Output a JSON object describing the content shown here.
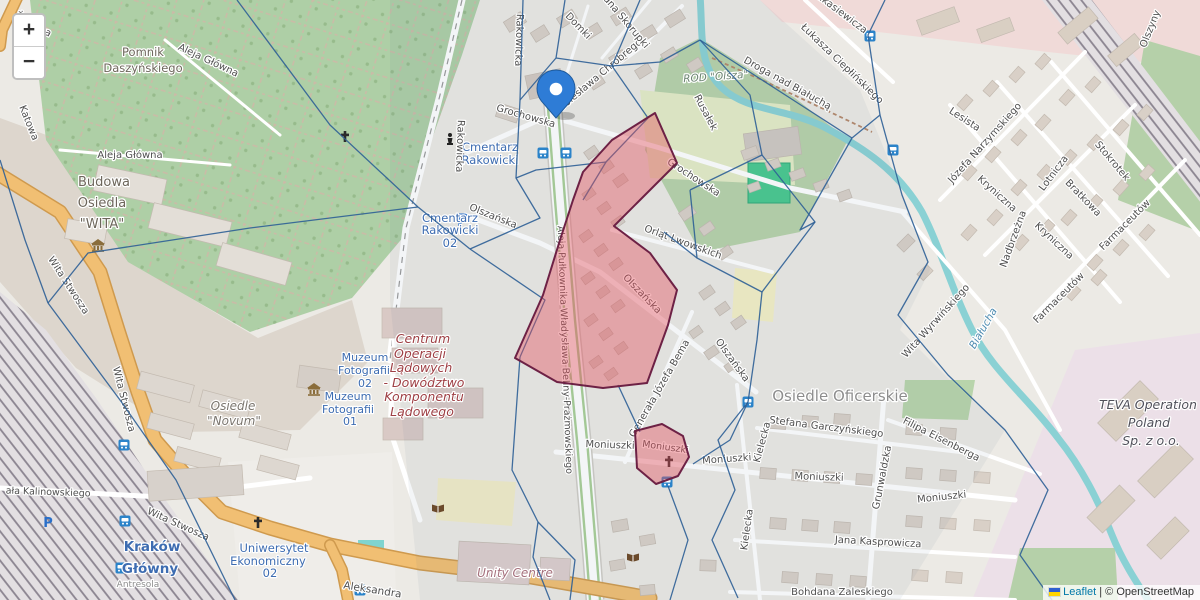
{
  "controls": {
    "zoom_in": "+",
    "zoom_out": "−"
  },
  "attribution": {
    "leaflet": "Leaflet",
    "separator": "|",
    "osm": "© OpenStreetMap"
  },
  "colors": {
    "voronoi_line": "#2e5f96",
    "highlight_fill": "#e4525e",
    "highlight_border": "#6d2145",
    "marker_blue": "#2e7cd6",
    "road_orange": "#f1bf73",
    "river_teal": "#8ad1d4",
    "cemetery_green": "#aecfa6",
    "poi_blue": "#3d6cb1"
  },
  "map": {
    "marker": {
      "x": 556,
      "y": 118
    },
    "overlay": {
      "voronoi": [
        [
          [
            237,
            0
          ],
          [
            330,
            125
          ],
          [
            418,
            207
          ]
        ],
        [
          [
            418,
            207
          ],
          [
            470,
            249
          ]
        ],
        [
          [
            418,
            207
          ],
          [
            250,
            228
          ],
          [
            88,
            253
          ],
          [
            48,
            303
          ]
        ],
        [
          [
            0,
            160
          ],
          [
            25,
            240
          ],
          [
            48,
            303
          ]
        ],
        [
          [
            48,
            303
          ],
          [
            120,
            400
          ],
          [
            176,
            480
          ],
          [
            235,
            600
          ]
        ],
        [
          [
            470,
            249
          ],
          [
            540,
            218
          ],
          [
            516,
            178
          ],
          [
            520,
            100
          ],
          [
            523,
            0
          ]
        ],
        [
          [
            520,
            100
          ],
          [
            556,
            58
          ],
          [
            565,
            0
          ]
        ],
        [
          [
            556,
            58
          ],
          [
            612,
            66
          ],
          [
            640,
            0
          ]
        ],
        [
          [
            612,
            66
          ],
          [
            648,
            118
          ]
        ],
        [
          [
            648,
            118
          ],
          [
            606,
            162
          ],
          [
            536,
            170
          ],
          [
            516,
            178
          ]
        ],
        [
          [
            606,
            162
          ],
          [
            583,
            200
          ]
        ],
        [
          [
            470,
            249
          ],
          [
            545,
            300
          ],
          [
            520,
            357
          ]
        ],
        [
          [
            520,
            357
          ],
          [
            512,
            470
          ],
          [
            538,
            522
          ],
          [
            533,
            557
          ],
          [
            550,
            600
          ]
        ],
        [
          [
            538,
            522
          ],
          [
            575,
            560
          ],
          [
            570,
            600
          ]
        ],
        [
          [
            618,
            385
          ],
          [
            640,
            432
          ]
        ],
        [
          [
            668,
            486
          ],
          [
            688,
            540
          ],
          [
            670,
            600
          ]
        ],
        [
          [
            693,
            464
          ],
          [
            730,
            440
          ],
          [
            748,
            402
          ]
        ],
        [
          [
            748,
            402
          ],
          [
            757,
            340
          ],
          [
            762,
            292
          ]
        ],
        [
          [
            690,
            190
          ],
          [
            762,
            155
          ],
          [
            815,
            222
          ],
          [
            762,
            292
          ],
          [
            697,
            258
          ],
          [
            690,
            190
          ]
        ],
        [
          [
            697,
            258
          ],
          [
            664,
            232
          ]
        ],
        [
          [
            762,
            155
          ],
          [
            750,
            95
          ],
          [
            700,
            40
          ]
        ],
        [
          [
            700,
            40
          ],
          [
            660,
            62
          ],
          [
            612,
            66
          ]
        ],
        [
          [
            700,
            40
          ],
          [
            790,
            98
          ],
          [
            852,
            138
          ]
        ],
        [
          [
            852,
            138
          ],
          [
            800,
            230
          ],
          [
            815,
            222
          ]
        ],
        [
          [
            852,
            138
          ],
          [
            880,
            115
          ],
          [
            902,
            195
          ],
          [
            928,
            262
          ],
          [
            898,
            315
          ],
          [
            948,
            375
          ],
          [
            1005,
            430
          ],
          [
            1048,
            490
          ],
          [
            1020,
            555
          ],
          [
            1052,
            600
          ]
        ],
        [
          [
            880,
            115
          ],
          [
            868,
            35
          ],
          [
            885,
            0
          ]
        ],
        [
          [
            748,
            402
          ],
          [
            718,
            440
          ],
          [
            735,
            490
          ],
          [
            712,
            540
          ],
          [
            738,
            598
          ]
        ]
      ],
      "highlights": [
        [
          [
            655,
            113
          ],
          [
            677,
            163
          ],
          [
            637,
            203
          ],
          [
            614,
            226
          ],
          [
            650,
            253
          ],
          [
            677,
            290
          ],
          [
            668,
            325
          ],
          [
            647,
            383
          ],
          [
            603,
            388
          ],
          [
            557,
            382
          ],
          [
            515,
            358
          ],
          [
            543,
            295
          ],
          [
            560,
            240
          ],
          [
            573,
            200
          ],
          [
            583,
            172
          ],
          [
            612,
            140
          ]
        ],
        [
          [
            635,
            431
          ],
          [
            662,
            424
          ],
          [
            683,
            436
          ],
          [
            689,
            457
          ],
          [
            678,
            476
          ],
          [
            656,
            484
          ],
          [
            637,
            468
          ]
        ]
      ]
    },
    "labels": [
      {
        "t": "Żelazna",
        "x": 32,
        "y": 27,
        "r": 30
      },
      {
        "t": "Katowa",
        "x": 26,
        "y": 124,
        "r": 68
      },
      {
        "t": "Aleja Główna",
        "x": 207,
        "y": 63,
        "r": 25
      },
      {
        "t": "Aleja Główna",
        "x": 130,
        "y": 158,
        "r": 0
      },
      {
        "t": "Pomnik",
        "x": 143,
        "y": 56,
        "s": 11.5,
        "c": "#6d665b"
      },
      {
        "t": "Daszyńskiego",
        "x": 143,
        "y": 72,
        "s": 11.5,
        "c": "#6d665b"
      },
      {
        "t": "Budowa",
        "x": 104,
        "y": 186,
        "s": 13,
        "c": "#6d665b"
      },
      {
        "t": "Osiedla",
        "x": 102,
        "y": 207,
        "s": 13,
        "c": "#6d665b"
      },
      {
        "t": "\"WITA\"",
        "x": 102,
        "y": 228,
        "s": 13,
        "c": "#6d665b"
      },
      {
        "t": "Wita Stwosza",
        "x": 66,
        "y": 287,
        "r": 57
      },
      {
        "t": "Wita Stwosza",
        "x": 121,
        "y": 400,
        "r": 76
      },
      {
        "t": "Wita Stwosza",
        "x": 177,
        "y": 527,
        "r": 24
      },
      {
        "t": "ała Kalinowskiego",
        "x": 48,
        "y": 495,
        "r": 2,
        "s": 9.5
      },
      {
        "t": "Kraków",
        "x": 152,
        "y": 551,
        "s": 13.5,
        "c": "#3d6cb1",
        "b": 1
      },
      {
        "t": "Główny",
        "x": 150,
        "y": 573,
        "s": 13.5,
        "c": "#3d6cb1",
        "b": 1
      },
      {
        "t": "Antresola",
        "x": 138,
        "y": 587,
        "s": 9,
        "c": "#8c8c8c"
      },
      {
        "t": "Uniwersytet",
        "x": 274,
        "y": 552,
        "s": 11.5,
        "c": "#3d6cb1"
      },
      {
        "t": "Ekonomiczny",
        "x": 268,
        "y": 565,
        "s": 11.5,
        "c": "#3d6cb1"
      },
      {
        "t": "02",
        "x": 270,
        "y": 577,
        "s": 11.5,
        "c": "#3d6cb1"
      },
      {
        "t": "Aleksandra",
        "x": 372,
        "y": 593,
        "r": 9,
        "s": 10.5
      },
      {
        "t": "Unity Centre",
        "x": 515,
        "y": 577,
        "s": 12,
        "c": "#a5707c",
        "i": 1
      },
      {
        "t": "Osiedle",
        "x": 233,
        "y": 410,
        "s": 12,
        "c": "#7a756e",
        "i": 1
      },
      {
        "t": "\"Novum\"",
        "x": 234,
        "y": 425,
        "s": 12,
        "c": "#7a756e",
        "i": 1
      },
      {
        "t": "Muzeum",
        "x": 365,
        "y": 361,
        "s": 11,
        "c": "#3d6cb1"
      },
      {
        "t": "Fotografii",
        "x": 364,
        "y": 374,
        "s": 11,
        "c": "#3d6cb1"
      },
      {
        "t": "02",
        "x": 365,
        "y": 387,
        "s": 11,
        "c": "#3d6cb1"
      },
      {
        "t": "Muzeum",
        "x": 348,
        "y": 400,
        "s": 11,
        "c": "#3d6cb1"
      },
      {
        "t": "Fotografii",
        "x": 348,
        "y": 413,
        "s": 11,
        "c": "#3d6cb1"
      },
      {
        "t": "01",
        "x": 350,
        "y": 425,
        "s": 11,
        "c": "#3d6cb1"
      },
      {
        "t": "Centrum",
        "x": 423,
        "y": 343,
        "s": 12.5,
        "c": "#9e3f44",
        "i": 1
      },
      {
        "t": "Operacji",
        "x": 420,
        "y": 358,
        "s": 12.5,
        "c": "#9e3f44",
        "i": 1
      },
      {
        "t": "Lądowych",
        "x": 421,
        "y": 372,
        "s": 12.5,
        "c": "#9e3f44",
        "i": 1
      },
      {
        "t": "- Dowództwo",
        "x": 424,
        "y": 387,
        "s": 12.5,
        "c": "#9e3f44",
        "i": 1
      },
      {
        "t": "Komponentu",
        "x": 424,
        "y": 401,
        "s": 12.5,
        "c": "#9e3f44",
        "i": 1
      },
      {
        "t": "Lądowego",
        "x": 422,
        "y": 416,
        "s": 12.5,
        "c": "#9e3f44",
        "i": 1
      },
      {
        "t": "Cmentarz",
        "x": 490,
        "y": 151,
        "s": 11.5,
        "c": "#3d6cb1"
      },
      {
        "t": "Rakowicki",
        "x": 490,
        "y": 164,
        "s": 11.5,
        "c": "#3d6cb1"
      },
      {
        "t": "Cmentarz",
        "x": 450,
        "y": 222,
        "s": 11.5,
        "c": "#3d6cb1"
      },
      {
        "t": "Rakowicki",
        "x": 450,
        "y": 234,
        "s": 11.5,
        "c": "#3d6cb1"
      },
      {
        "t": "02",
        "x": 450,
        "y": 247,
        "s": 11.5,
        "c": "#3d6cb1"
      },
      {
        "t": "Rakowicka",
        "x": 457,
        "y": 146,
        "r": 92
      },
      {
        "t": "Rakowicka",
        "x": 516,
        "y": 40,
        "r": 92
      },
      {
        "t": "Grochowska",
        "x": 525,
        "y": 119,
        "r": 16
      },
      {
        "t": "Grochowska",
        "x": 692,
        "y": 180,
        "r": 33
      },
      {
        "t": "Bolesława Chrobrego",
        "x": 602,
        "y": 77,
        "r": -40
      },
      {
        "t": "Domki",
        "x": 576,
        "y": 28,
        "r": 46
      },
      {
        "t": "ana Skorupki",
        "x": 624,
        "y": 24,
        "r": 50
      },
      {
        "t": "Olszańska",
        "x": 492,
        "y": 219,
        "r": 22
      },
      {
        "t": "Olszańska",
        "x": 640,
        "y": 296,
        "r": 46
      },
      {
        "t": "Olszańska",
        "x": 730,
        "y": 362,
        "r": 54
      },
      {
        "t": "Orląt Lwowskich",
        "x": 682,
        "y": 245,
        "r": 20
      },
      {
        "t": "Aleja Pułkownika Władysława Beliny-Prażmowskiego",
        "x": 562,
        "y": 350,
        "r": 88,
        "s": 9.5
      },
      {
        "t": "Generała Józefa Bema",
        "x": 662,
        "y": 390,
        "r": -60
      },
      {
        "t": "Moniuszki",
        "x": 610,
        "y": 448,
        "r": 2
      },
      {
        "t": "Moniuszki",
        "x": 665,
        "y": 450,
        "r": 8,
        "s": 9.5
      },
      {
        "t": "Moniuszki",
        "x": 727,
        "y": 462,
        "r": -4
      },
      {
        "t": "Moniuszki",
        "x": 819,
        "y": 480,
        "r": 2
      },
      {
        "t": "Moniuszki",
        "x": 942,
        "y": 500,
        "r": -6
      },
      {
        "t": "Osiedle Oficerskie",
        "x": 840,
        "y": 401,
        "s": 15,
        "c": "#8d8d8d"
      },
      {
        "t": "Stefana Garczyńskiego",
        "x": 826,
        "y": 430,
        "r": 7
      },
      {
        "t": "Filipa Eisenberga",
        "x": 940,
        "y": 442,
        "r": 27
      },
      {
        "t": "Grunwaldzka",
        "x": 885,
        "y": 478,
        "r": -79
      },
      {
        "t": "Kielecka",
        "x": 765,
        "y": 443,
        "r": -75
      },
      {
        "t": "Kielecka",
        "x": 750,
        "y": 530,
        "r": -82
      },
      {
        "t": "Jana Kasprowicza",
        "x": 878,
        "y": 545,
        "r": 3
      },
      {
        "t": "Bohdana Zaleskiego",
        "x": 842,
        "y": 595,
        "r": 0
      },
      {
        "t": "ROD \"Olsza\"",
        "x": 716,
        "y": 80,
        "r": -4,
        "s": 10.5,
        "c": "#6c8472",
        "i": 1
      },
      {
        "t": "Rusałek",
        "x": 703,
        "y": 114,
        "r": 62
      },
      {
        "t": "Droga nad Białuchą",
        "x": 786,
        "y": 86,
        "r": 29
      },
      {
        "t": "Łukasza Ciepłińskiego",
        "x": 840,
        "y": 66,
        "r": 44
      },
      {
        "t": "Łukasiewicza",
        "x": 838,
        "y": 14,
        "r": 37
      },
      {
        "t": "Olszyny",
        "x": 1153,
        "y": 30,
        "r": -68
      },
      {
        "t": "Lesista",
        "x": 963,
        "y": 122,
        "r": 33
      },
      {
        "t": "Józefa Narzymskiego",
        "x": 987,
        "y": 145,
        "r": -48
      },
      {
        "t": "Kryniczna",
        "x": 995,
        "y": 196,
        "r": 42
      },
      {
        "t": "Kryniczna",
        "x": 1052,
        "y": 243,
        "r": 43
      },
      {
        "t": "Lotnicza",
        "x": 1056,
        "y": 175,
        "r": -53
      },
      {
        "t": "Stokrotek",
        "x": 1110,
        "y": 163,
        "r": 50
      },
      {
        "t": "Bratkowa",
        "x": 1081,
        "y": 200,
        "r": 46
      },
      {
        "t": "Farmaceutów",
        "x": 1127,
        "y": 227,
        "r": -45
      },
      {
        "t": "Farmaceutów",
        "x": 1061,
        "y": 300,
        "r": -45
      },
      {
        "t": "Nadbrzeżna",
        "x": 1016,
        "y": 240,
        "r": -70
      },
      {
        "t": "Wita Wyrwińskiego",
        "x": 938,
        "y": 323,
        "r": -48
      },
      {
        "t": "Białucha",
        "x": 986,
        "y": 330,
        "r": -60,
        "s": 10.5,
        "c": "#4e8bb0",
        "i": 1
      },
      {
        "t": "TEVA Operation",
        "x": 1148,
        "y": 409,
        "s": 12.5,
        "c": "#50505a",
        "i": 1
      },
      {
        "t": "Poland",
        "x": 1149,
        "y": 427,
        "s": 12.5,
        "c": "#50505a",
        "i": 1
      },
      {
        "t": "Sp. z o.o.",
        "x": 1151,
        "y": 445,
        "s": 12.5,
        "c": "#50505a",
        "i": 1
      }
    ],
    "icons": [
      {
        "t": "cross",
        "x": 345,
        "y": 137
      },
      {
        "t": "cross",
        "x": 258,
        "y": 523
      },
      {
        "t": "cross",
        "x": 669,
        "y": 462
      },
      {
        "t": "museum",
        "x": 98,
        "y": 245
      },
      {
        "t": "museum",
        "x": 314,
        "y": 389
      },
      {
        "t": "library",
        "x": 438,
        "y": 508
      },
      {
        "t": "library",
        "x": 633,
        "y": 557
      },
      {
        "t": "statue",
        "x": 450,
        "y": 140
      },
      {
        "t": "parking",
        "x": 463,
        "y": 226,
        "s": 17
      },
      {
        "t": "parking",
        "x": 48,
        "y": 527,
        "s": 13
      },
      {
        "t": "bus",
        "x": 543,
        "y": 153
      },
      {
        "t": "bus",
        "x": 566,
        "y": 153
      },
      {
        "t": "bus",
        "x": 748,
        "y": 402
      },
      {
        "t": "bus",
        "x": 870,
        "y": 36
      },
      {
        "t": "bus",
        "x": 124,
        "y": 445
      },
      {
        "t": "bus",
        "x": 125,
        "y": 521
      },
      {
        "t": "bus",
        "x": 121,
        "y": 568
      },
      {
        "t": "bus",
        "x": 667,
        "y": 482
      },
      {
        "t": "bus",
        "x": 893,
        "y": 150
      },
      {
        "t": "bus",
        "x": 360,
        "y": 590
      }
    ]
  }
}
